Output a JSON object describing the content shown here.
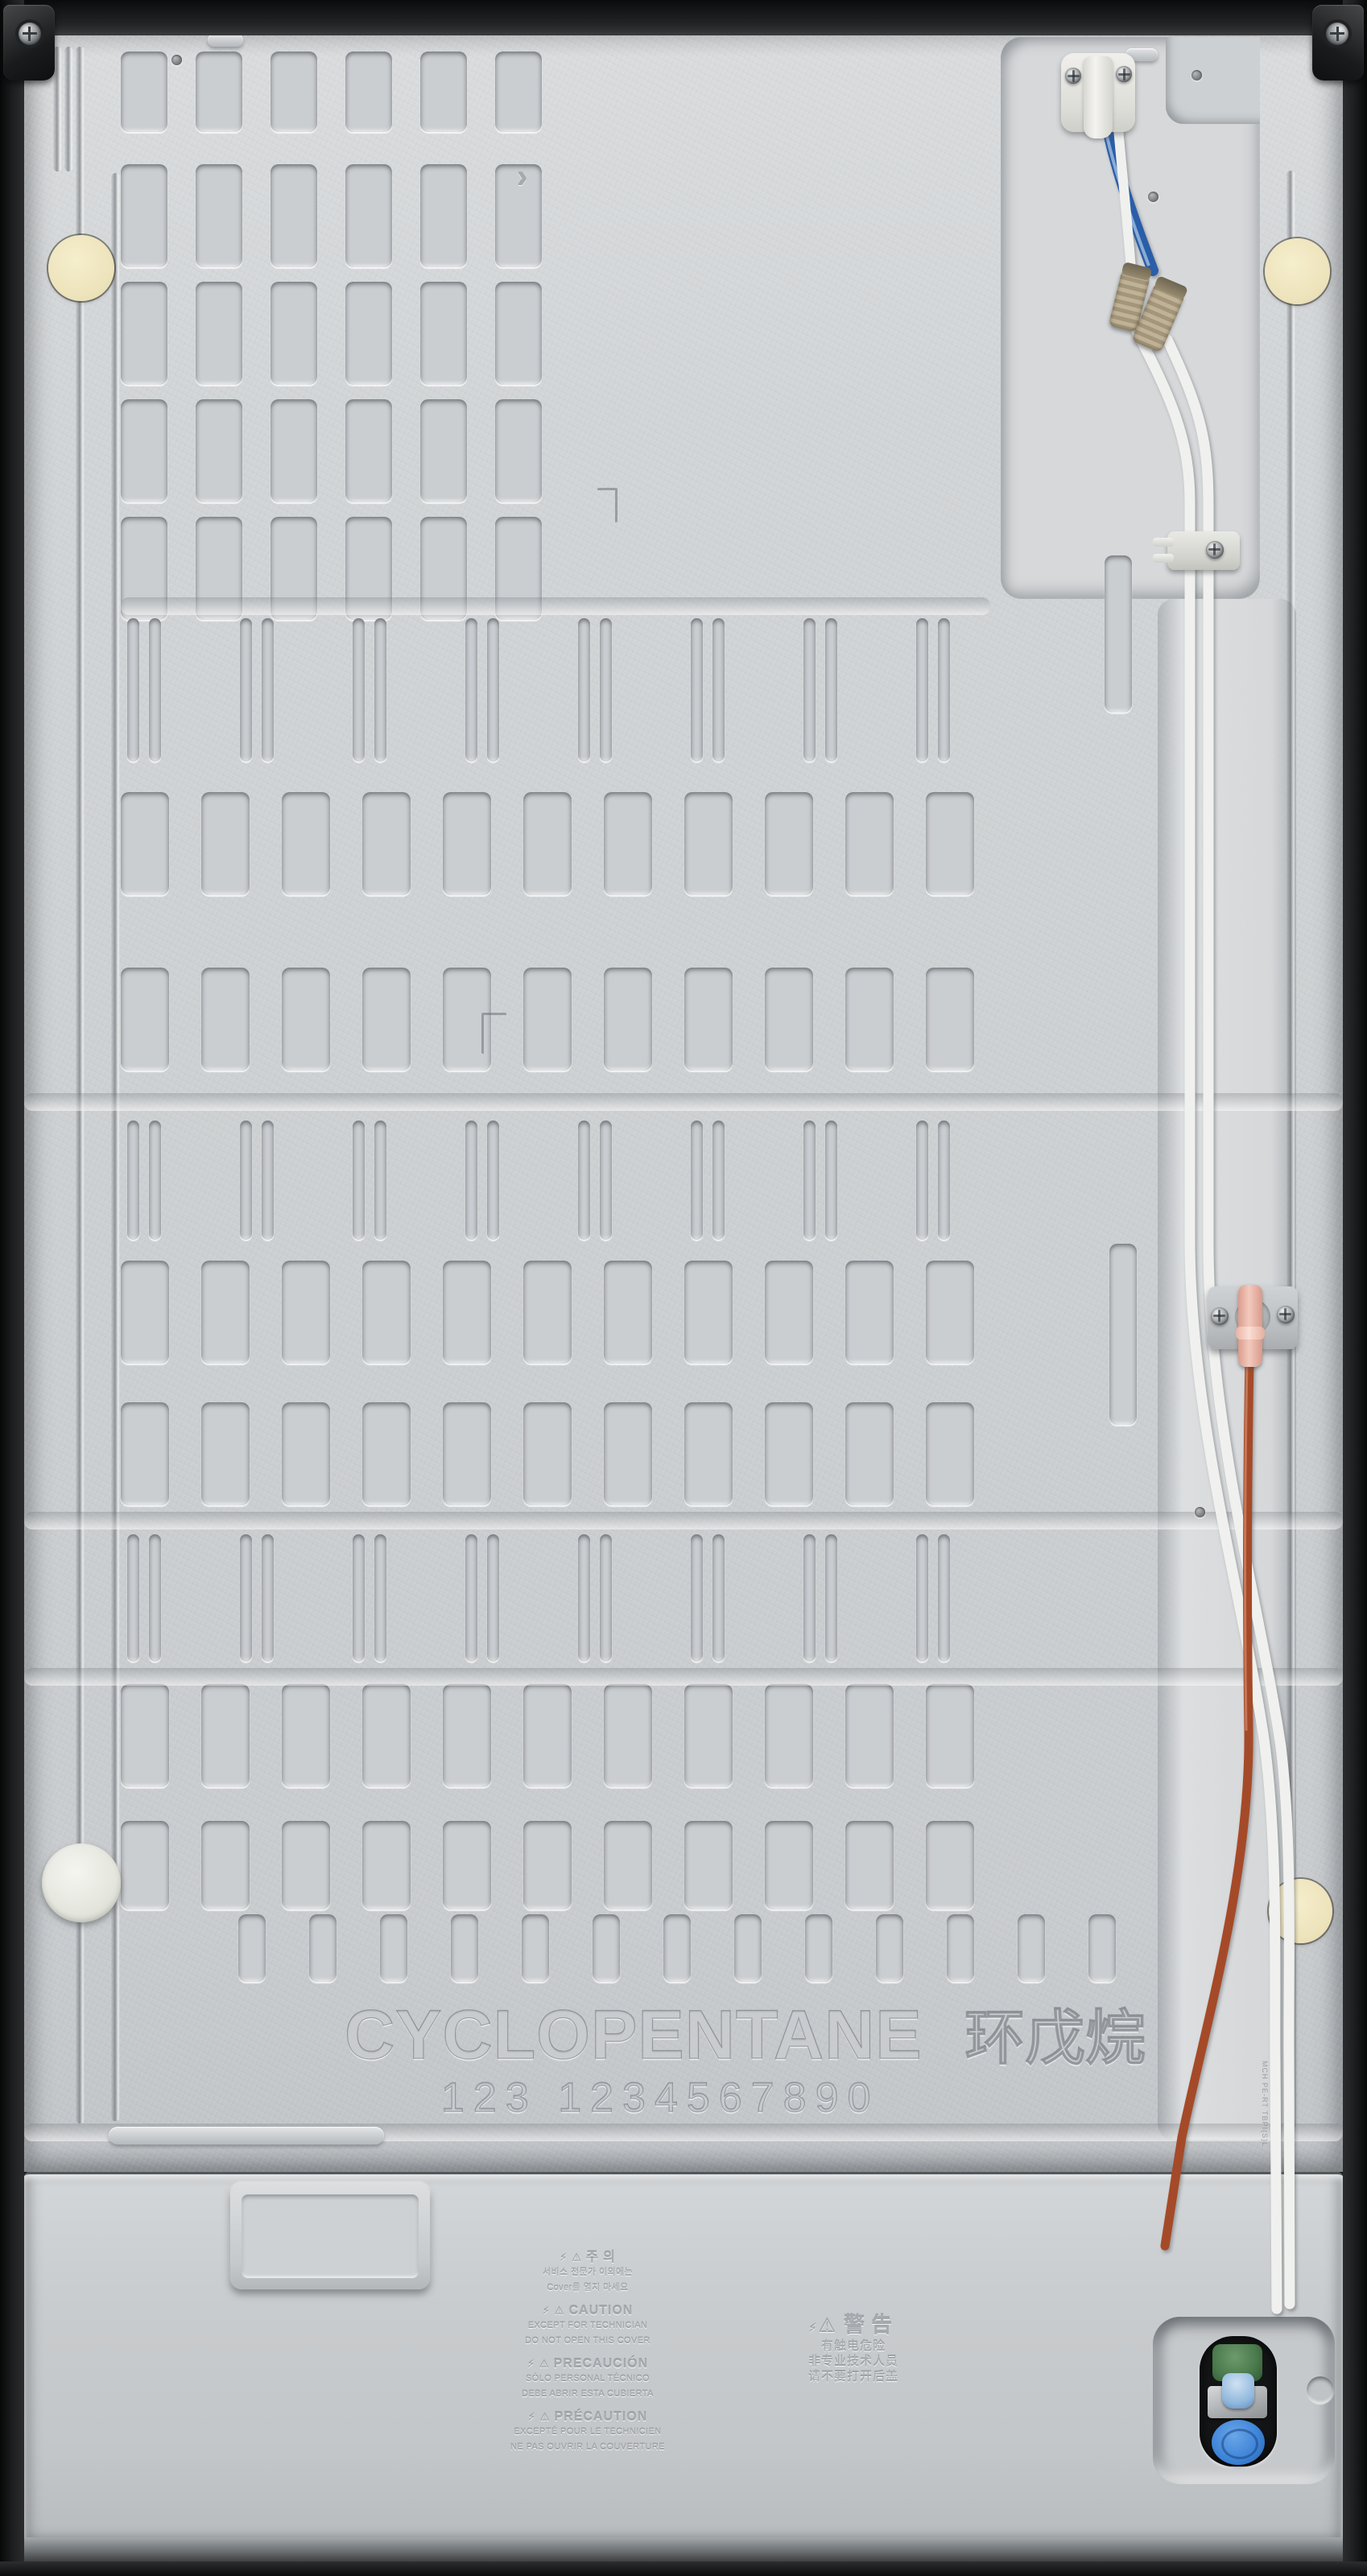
{
  "scene": {
    "description": "Rear view of a refrigerator back panel with water tubing and compressor cover",
    "embossed_brand": "CYCLOPENTANE",
    "embossed_brand_cjk": "环戊烷",
    "embossed_digits": "123 1234567890",
    "tube_print": "MCH PE-RT TBPI(S)L"
  },
  "icons": {
    "bolt": "⚡",
    "warning_triangle": "⚠",
    "chevron": "›"
  },
  "warning_labels": {
    "korean": {
      "title": "주 의",
      "lines": [
        "서비스 전문가 이외에는",
        "Cover를 열지 마세요"
      ]
    },
    "english": {
      "title": "CAUTION",
      "lines": [
        "EXCEPT FOR TECHNICIAN",
        "DO NOT OPEN THIS COVER"
      ]
    },
    "spanish": {
      "title": "PRECAUCIÓN",
      "lines": [
        "SÓLO PERSONAL TÉCNICO",
        "DEBE ABRIR ESTA CUBIERTA"
      ]
    },
    "french": {
      "title": "PRÉCAUTION",
      "lines": [
        "EXCEPTÉ POUR LE TECHNICIEN",
        "NE PAS OUVRIR LA COUVERTURE"
      ]
    },
    "chinese": {
      "title": "警告",
      "lines": [
        "有触电危险",
        "非专业技术人员",
        "请不要打开后盖"
      ]
    }
  },
  "colors": {
    "panel": "#cdd0d2",
    "frame": "#17181a",
    "tube_white": "#f0f1ee",
    "tube_blue": "#2a5ea8",
    "tube_copper": "#a54a28",
    "connector_tan": "#b0a184",
    "connector_pink": "#eec0b4",
    "valve_green": "#4d7c4f",
    "valve_cap_blue": "#3b82d6",
    "pad_yellow": "#f0e8c4"
  }
}
